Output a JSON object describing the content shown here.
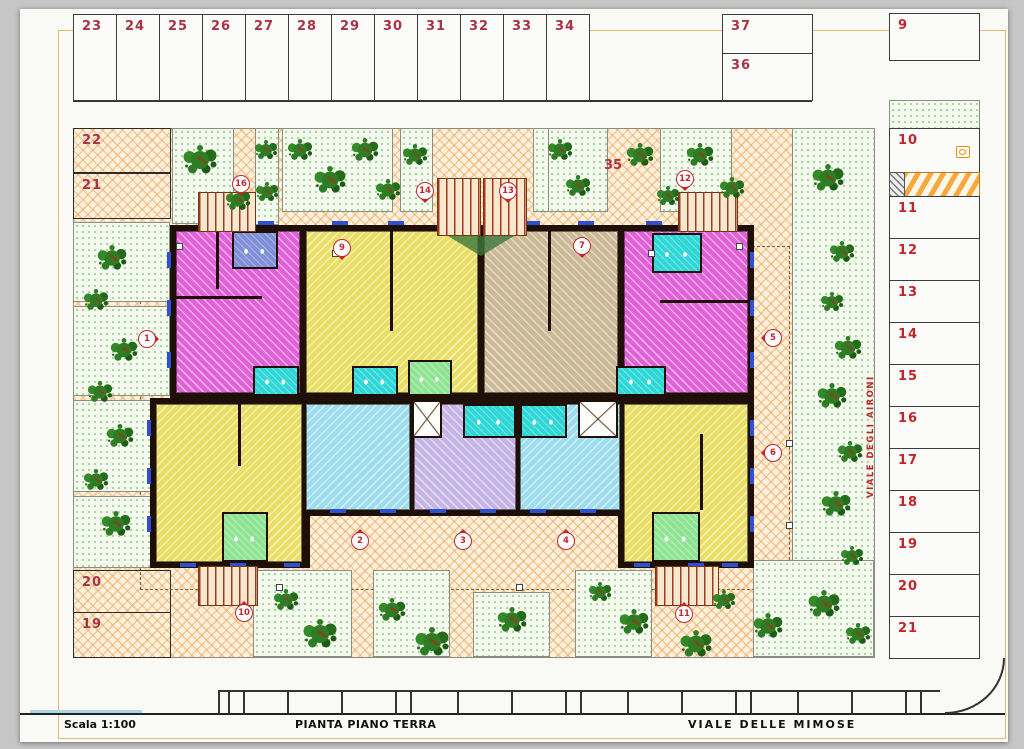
{
  "sheet": {
    "scale_label": "Scala 1:100",
    "plan_title": "PIANTA PIANO TERRA",
    "street_bottom": "VIALE  DELLE  MIMOSE",
    "street_right": "VIALE DEGLI AIRONI",
    "area_label": "35"
  },
  "parking": {
    "top_row": [
      "23",
      "24",
      "25",
      "26",
      "27",
      "28",
      "29",
      "30",
      "31",
      "32",
      "33",
      "34"
    ],
    "stacked_right": [
      "37",
      "36"
    ],
    "corner_right": "9",
    "right_column": [
      "10",
      "11",
      "12",
      "13",
      "14",
      "15",
      "16",
      "17",
      "18",
      "19",
      "20",
      "21"
    ],
    "left_top": [
      "22",
      "21"
    ],
    "left_bottom": [
      "20",
      "19"
    ]
  },
  "entry_markers": [
    {
      "label": "1",
      "x": 146,
      "y": 338,
      "dir": "right"
    },
    {
      "label": "2",
      "x": 359,
      "y": 540,
      "dir": "up"
    },
    {
      "label": "3",
      "x": 462,
      "y": 540,
      "dir": "up"
    },
    {
      "label": "4",
      "x": 565,
      "y": 540,
      "dir": "up"
    },
    {
      "label": "5",
      "x": 772,
      "y": 337,
      "dir": "left"
    },
    {
      "label": "6",
      "x": 772,
      "y": 452,
      "dir": "left"
    },
    {
      "label": "7",
      "x": 581,
      "y": 245,
      "dir": "down"
    },
    {
      "label": "9",
      "x": 341,
      "y": 247,
      "dir": "down"
    },
    {
      "label": "10",
      "x": 243,
      "y": 612,
      "dir": "up"
    },
    {
      "label": "11",
      "x": 683,
      "y": 613,
      "dir": "up"
    },
    {
      "label": "12",
      "x": 684,
      "y": 178,
      "dir": "down"
    },
    {
      "label": "13",
      "x": 507,
      "y": 190,
      "dir": "down"
    },
    {
      "label": "14",
      "x": 424,
      "y": 190,
      "dir": "down"
    },
    {
      "label": "16",
      "x": 240,
      "y": 183,
      "dir": "down"
    }
  ],
  "landscape": {
    "planters": [
      [
        172,
        128,
        62,
        96
      ],
      [
        255,
        128,
        24,
        97
      ],
      [
        282,
        128,
        111,
        84
      ],
      [
        400,
        128,
        33,
        84
      ],
      [
        533,
        128,
        16,
        84
      ],
      [
        548,
        128,
        60,
        84
      ],
      [
        660,
        128,
        72,
        84
      ],
      [
        73,
        222,
        97,
        80
      ],
      [
        73,
        306,
        97,
        90
      ],
      [
        73,
        400,
        97,
        92
      ],
      [
        73,
        496,
        97,
        72
      ],
      [
        253,
        570,
        99,
        87
      ],
      [
        373,
        570,
        77,
        87
      ],
      [
        473,
        592,
        77,
        65
      ],
      [
        575,
        570,
        77,
        87
      ]
    ],
    "lawns": [
      [
        792,
        128,
        83,
        530
      ],
      [
        753,
        560,
        121,
        97
      ]
    ],
    "trees": [
      [
        200,
        160,
        1.5
      ],
      [
        238,
        200,
        1.1
      ],
      [
        266,
        150,
        1
      ],
      [
        267,
        192,
        1
      ],
      [
        300,
        150,
        1.1
      ],
      [
        330,
        180,
        1.4
      ],
      [
        365,
        150,
        1.2
      ],
      [
        388,
        190,
        1.1
      ],
      [
        415,
        155,
        1.1
      ],
      [
        560,
        150,
        1.1
      ],
      [
        578,
        186,
        1.1
      ],
      [
        640,
        155,
        1.2
      ],
      [
        668,
        196,
        1
      ],
      [
        700,
        155,
        1.2
      ],
      [
        732,
        188,
        1.1
      ],
      [
        112,
        258,
        1.3
      ],
      [
        96,
        300,
        1.1
      ],
      [
        124,
        350,
        1.2
      ],
      [
        100,
        392,
        1.1
      ],
      [
        120,
        436,
        1.2
      ],
      [
        96,
        480,
        1.1
      ],
      [
        116,
        524,
        1.3
      ],
      [
        286,
        600,
        1.1
      ],
      [
        320,
        634,
        1.5
      ],
      [
        392,
        610,
        1.2
      ],
      [
        432,
        642,
        1.5
      ],
      [
        512,
        620,
        1.3
      ],
      [
        600,
        592,
        1
      ],
      [
        634,
        622,
        1.3
      ],
      [
        696,
        644,
        1.4
      ],
      [
        724,
        600,
        1
      ],
      [
        828,
        178,
        1.4
      ],
      [
        842,
        252,
        1.1
      ],
      [
        832,
        302,
        1
      ],
      [
        848,
        348,
        1.2
      ],
      [
        832,
        396,
        1.3
      ],
      [
        850,
        452,
        1.1
      ],
      [
        836,
        504,
        1.3
      ],
      [
        852,
        556,
        1
      ],
      [
        824,
        604,
        1.4
      ],
      [
        858,
        634,
        1.1
      ],
      [
        768,
        626,
        1.3
      ]
    ]
  },
  "building": {
    "apartments": [
      {
        "id": "nw",
        "color": "magenta",
        "x": 176,
        "y": 231,
        "w": 124,
        "h": 162
      },
      {
        "id": "n1",
        "color": "yellow",
        "x": 306,
        "y": 231,
        "w": 172,
        "h": 162
      },
      {
        "id": "n2",
        "color": "tan",
        "x": 484,
        "y": 231,
        "w": 134,
        "h": 162
      },
      {
        "id": "ne",
        "color": "magenta",
        "x": 624,
        "y": 231,
        "w": 124,
        "h": 162
      },
      {
        "id": "sw",
        "color": "yellow",
        "x": 156,
        "y": 404,
        "w": 146,
        "h": 158
      },
      {
        "id": "s1",
        "color": "blue",
        "x": 306,
        "y": 404,
        "w": 104,
        "h": 106
      },
      {
        "id": "s2",
        "color": "lavender",
        "x": 414,
        "y": 404,
        "w": 102,
        "h": 106
      },
      {
        "id": "s3",
        "color": "blue",
        "x": 520,
        "y": 404,
        "w": 100,
        "h": 106
      },
      {
        "id": "se",
        "color": "yellow",
        "x": 624,
        "y": 404,
        "w": 124,
        "h": 158
      }
    ],
    "bathrooms": [
      {
        "color": "bluepurple",
        "x": 232,
        "y": 231,
        "w": 46,
        "h": 38
      },
      {
        "color": "cyan",
        "x": 652,
        "y": 233,
        "w": 50,
        "h": 40
      },
      {
        "color": "cyan",
        "x": 253,
        "y": 366,
        "w": 46,
        "h": 30
      },
      {
        "color": "cyan",
        "x": 352,
        "y": 366,
        "w": 46,
        "h": 30
      },
      {
        "color": "green",
        "x": 408,
        "y": 360,
        "w": 44,
        "h": 36
      },
      {
        "color": "cyan",
        "x": 463,
        "y": 404,
        "w": 53,
        "h": 34
      },
      {
        "color": "cyan",
        "x": 520,
        "y": 404,
        "w": 47,
        "h": 34
      },
      {
        "color": "cyan",
        "x": 616,
        "y": 366,
        "w": 50,
        "h": 30
      },
      {
        "color": "green",
        "x": 222,
        "y": 512,
        "w": 46,
        "h": 50
      },
      {
        "color": "green",
        "x": 652,
        "y": 512,
        "w": 48,
        "h": 50
      }
    ],
    "stair_cores": [
      [
        412,
        400,
        30,
        38
      ],
      [
        578,
        400,
        40,
        38
      ]
    ]
  },
  "colors": {
    "marker_red": "#c2272d",
    "stall_number": "#a83345",
    "frame": "#e3bb79",
    "wall": "#1e1008",
    "paving": "#fdf1dd",
    "paving_hatch": "#eea050",
    "lawn_dot": "#6eb464",
    "magenta": "#e160d8",
    "yellow": "#eadf66",
    "tan": "#ccb996",
    "blue": "#9edded",
    "lavender": "#c6b4e6",
    "cyan": "#2fd6d6",
    "green": "#8fe493",
    "bluepurple": "#7f8fd8"
  }
}
